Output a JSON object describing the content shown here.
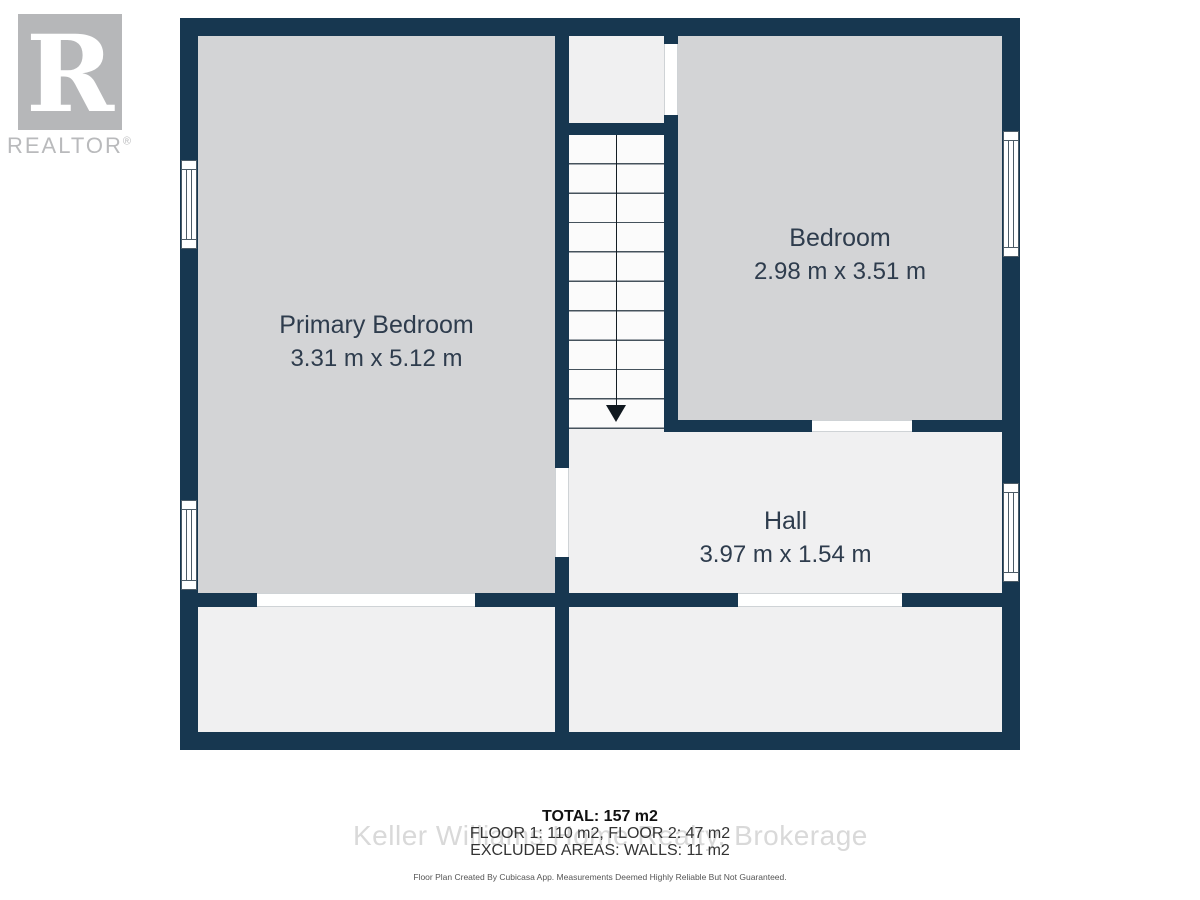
{
  "logo": {
    "glyph": "R",
    "wordmark": "REALTOR",
    "registered": "®"
  },
  "rooms": {
    "primary": {
      "name": "Primary Bedroom",
      "dims": "3.31 m x 5.12 m"
    },
    "bedroom": {
      "name": "Bedroom",
      "dims": "2.98 m x 3.51 m"
    },
    "hall": {
      "name": "Hall",
      "dims": "3.97 m x 1.54 m"
    }
  },
  "summary": {
    "total": "TOTAL: 157 m2",
    "floors": "FLOOR 1: 110 m2, FLOOR 2: 47 m2",
    "excluded": "EXCLUDED AREAS: WALLS: 11 m2"
  },
  "disclaimer": "Floor Plan Created By Cubicasa App. Measurements Deemed Highly Reliable But Not Guaranteed.",
  "watermark": "Keller Williams Home Realty, Brokerage",
  "colors": {
    "wall": "#173750",
    "room_gray": "#d3d4d6",
    "room_light": "#f0f0f1",
    "label_text": "#2e3c4d",
    "logo_gray": "#b6b7b9",
    "watermark_gray": "#d9d9d9"
  }
}
